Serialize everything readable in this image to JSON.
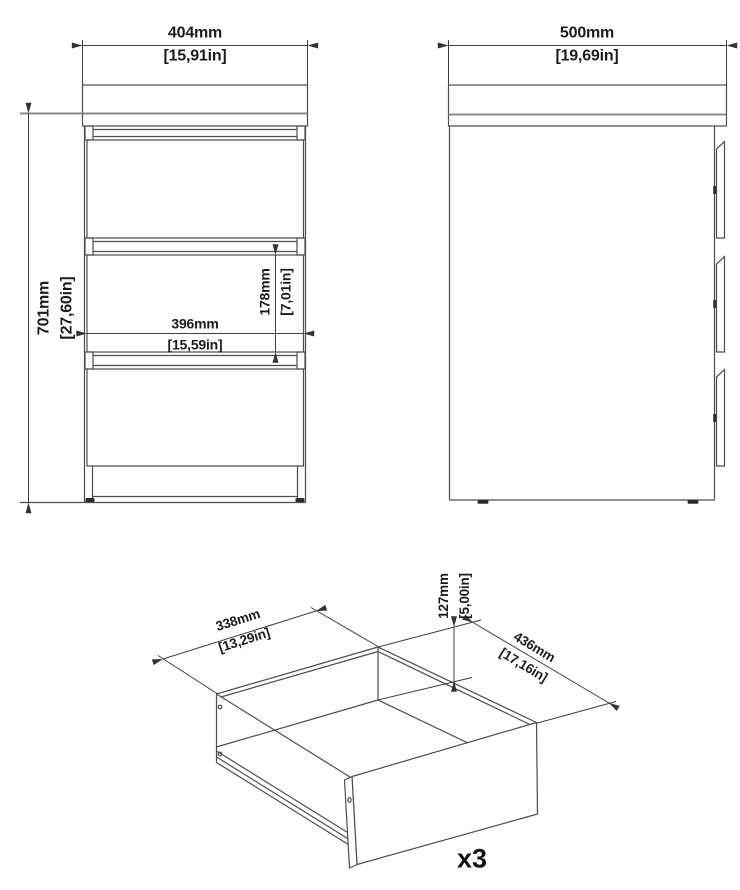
{
  "drawing": {
    "front_view": {
      "overall_width": {
        "mm": "404mm",
        "inches": "[15,91in]"
      },
      "overall_height": {
        "mm": "701mm",
        "inches": "[27,60in]"
      },
      "drawer_front_width": {
        "mm": "396mm",
        "inches": "[15,59in]"
      },
      "drawer_front_height": {
        "mm": "178mm",
        "inches": "[7,01in]"
      }
    },
    "side_view": {
      "overall_depth": {
        "mm": "500mm",
        "inches": "[19,69in]"
      }
    },
    "drawer_view": {
      "inner_width": {
        "mm": "338mm",
        "inches": "[13,29in]"
      },
      "inner_height": {
        "mm": "127mm",
        "inches": "[5,00in]"
      },
      "inner_depth": {
        "mm": "436mm",
        "inches": "[17,16in]"
      },
      "quantity": "x3"
    }
  }
}
